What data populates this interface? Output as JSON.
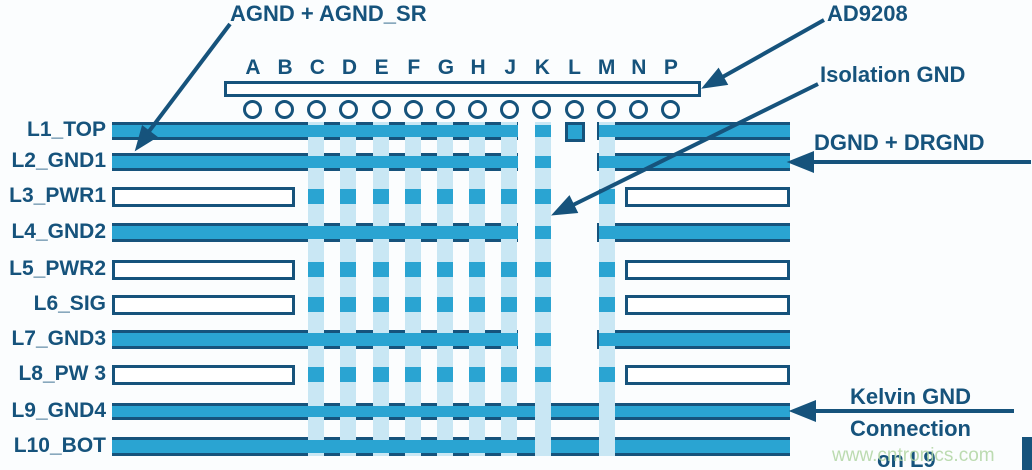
{
  "diagram": {
    "annotations": {
      "agnd": "AGND + AGND_SR",
      "chip": "AD9208",
      "isolation": "Isolation GND",
      "dgnd": "DGND + DRGND",
      "kelvin_line1": "Kelvin GND",
      "kelvin_line2": "Connection",
      "kelvin_line3": "on L9"
    },
    "watermark": "www.cntronics.com",
    "colors": {
      "cyan": "#2aa4d2",
      "navy": "#16537c",
      "pale": "#c9e7f4",
      "background": "#fbfdfe",
      "watermark_green": "#b2d6a4"
    },
    "ball_columns": {
      "letters": [
        "A",
        "B",
        "C",
        "D",
        "E",
        "F",
        "G",
        "H",
        "J",
        "K",
        "L",
        "M",
        "N",
        "P"
      ],
      "first_x": 253,
      "pitch": 32.15
    },
    "chip_outline": {
      "x": 224,
      "y": 81,
      "w": 471,
      "h": 10
    },
    "layers": [
      {
        "label": "L1_TOP",
        "y": 122,
        "h": 18,
        "style": "plane",
        "segments": [
          [
            112,
            518
          ],
          [
            597,
            790
          ]
        ]
      },
      {
        "label": "L2_GND1",
        "y": 153,
        "h": 18,
        "style": "plane",
        "segments": [
          [
            112,
            518
          ],
          [
            597,
            790
          ]
        ]
      },
      {
        "label": "L3_PWR1",
        "y": 187,
        "h": 20,
        "style": "outline",
        "segments": [
          [
            112,
            295
          ],
          [
            625,
            790
          ]
        ]
      },
      {
        "label": "L4_GND2",
        "y": 223,
        "h": 19,
        "style": "plane",
        "segments": [
          [
            112,
            518
          ],
          [
            597,
            790
          ]
        ]
      },
      {
        "label": "L5_PWR2",
        "y": 260,
        "h": 20,
        "style": "outline",
        "segments": [
          [
            112,
            295
          ],
          [
            625,
            790
          ]
        ]
      },
      {
        "label": "L6_SIG",
        "y": 295,
        "h": 20,
        "style": "outline",
        "segments": [
          [
            112,
            295
          ],
          [
            625,
            790
          ]
        ]
      },
      {
        "label": "L7_GND3",
        "y": 330,
        "h": 19,
        "style": "plane",
        "segments": [
          [
            112,
            518
          ],
          [
            597,
            790
          ]
        ]
      },
      {
        "label": "L8_PW 3",
        "y": 365,
        "h": 20,
        "style": "outline",
        "segments": [
          [
            112,
            295
          ],
          [
            625,
            790
          ]
        ]
      },
      {
        "label": "L9_GND4",
        "y": 403,
        "h": 17,
        "style": "plane",
        "segments": [
          [
            112,
            790
          ]
        ]
      },
      {
        "label": "L10_BOT",
        "y": 437,
        "h": 19,
        "style": "plane",
        "segments": [
          [
            112,
            790
          ]
        ]
      }
    ],
    "via_columns": [
      {
        "col": "C",
        "x": 308,
        "pale_over": []
      },
      {
        "col": "D",
        "x": 340,
        "pale_over": []
      },
      {
        "col": "E",
        "x": 373,
        "pale_over": []
      },
      {
        "col": "F",
        "x": 405,
        "pale_over": []
      },
      {
        "col": "G",
        "x": 437,
        "pale_over": []
      },
      {
        "col": "H",
        "x": 469,
        "pale_over": []
      },
      {
        "col": "J",
        "x": 501,
        "pale_over": []
      },
      {
        "col": "K",
        "x": 535,
        "pale_over": [
          "L9_GND4",
          "L10_BOT"
        ]
      },
      {
        "col": "M",
        "x": 599,
        "pale_over": [
          "L9_GND4",
          "L10_BOT"
        ]
      }
    ],
    "isolated_pad": {
      "x": 565,
      "y": 122,
      "w": 20,
      "h": 20
    },
    "corner_mark": {
      "x": 1022,
      "y": 437,
      "w": 10,
      "h": 33
    }
  }
}
